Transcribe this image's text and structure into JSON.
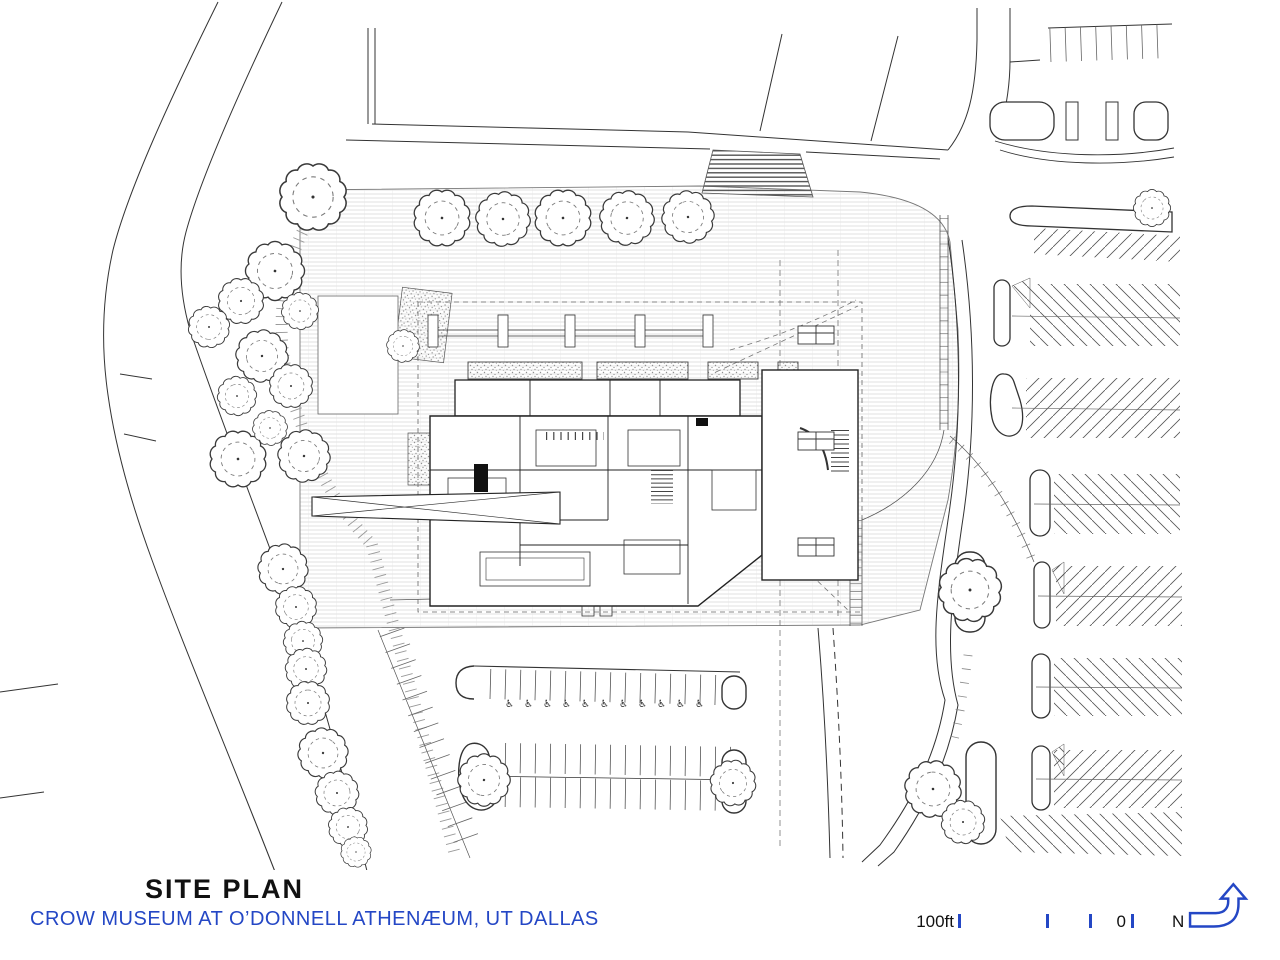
{
  "document": {
    "kind": "architectural site plan sheet"
  },
  "title_block": {
    "title": "SITE PLAN",
    "subtitle": "CROW MUSEUM AT O’DONNELL ATHENÆUM, UT DALLAS"
  },
  "scale_bar": {
    "label_left": "100ft",
    "label_zero": "0"
  },
  "north_arrow": {
    "label": "N"
  },
  "symbols": {
    "accessible_parking_icon": "♿"
  },
  "legend_features": [
    "museum building footprint",
    "entry plaza with paving grid",
    "street with curved curbs",
    "surface parking with diagonal stalls",
    "accessible parking row",
    "tree plantings",
    "crosswalk",
    "gravel planting beds"
  ],
  "colors": {
    "accent_blue": "#2447c5",
    "ink": "#111111",
    "drawing_line": "#333333",
    "background": "#ffffff"
  }
}
